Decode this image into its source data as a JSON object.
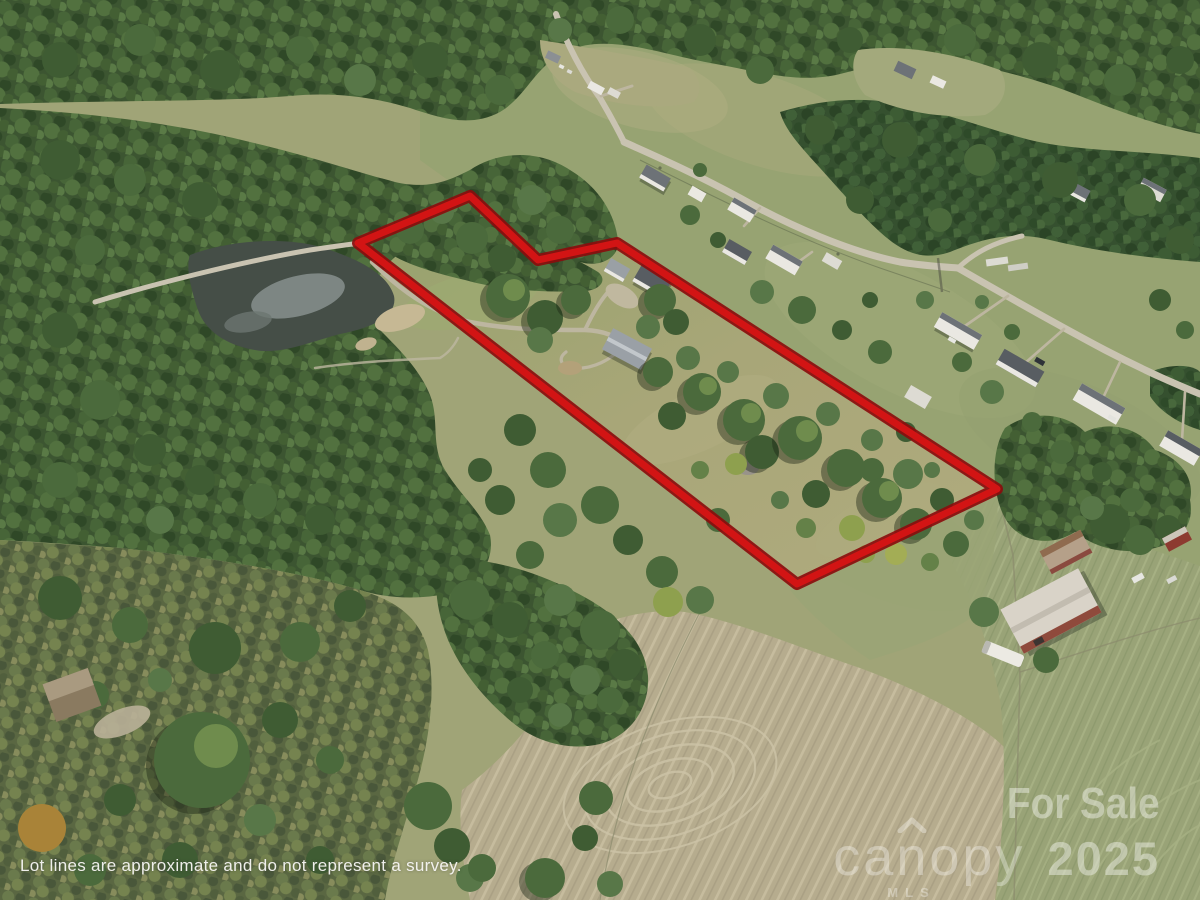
{
  "disclaimer": {
    "text": "Lot lines are approximate and do not represent a survey."
  },
  "watermark": {
    "for_sale": "For Sale",
    "brand": "canopy",
    "brand_sub": "MLS",
    "year": "2025"
  },
  "lot_outline": {
    "color": "#d21414",
    "edge_color": "#8a0d0d",
    "points": "358,243 470,196 538,260 617,243 997,489 797,584"
  }
}
